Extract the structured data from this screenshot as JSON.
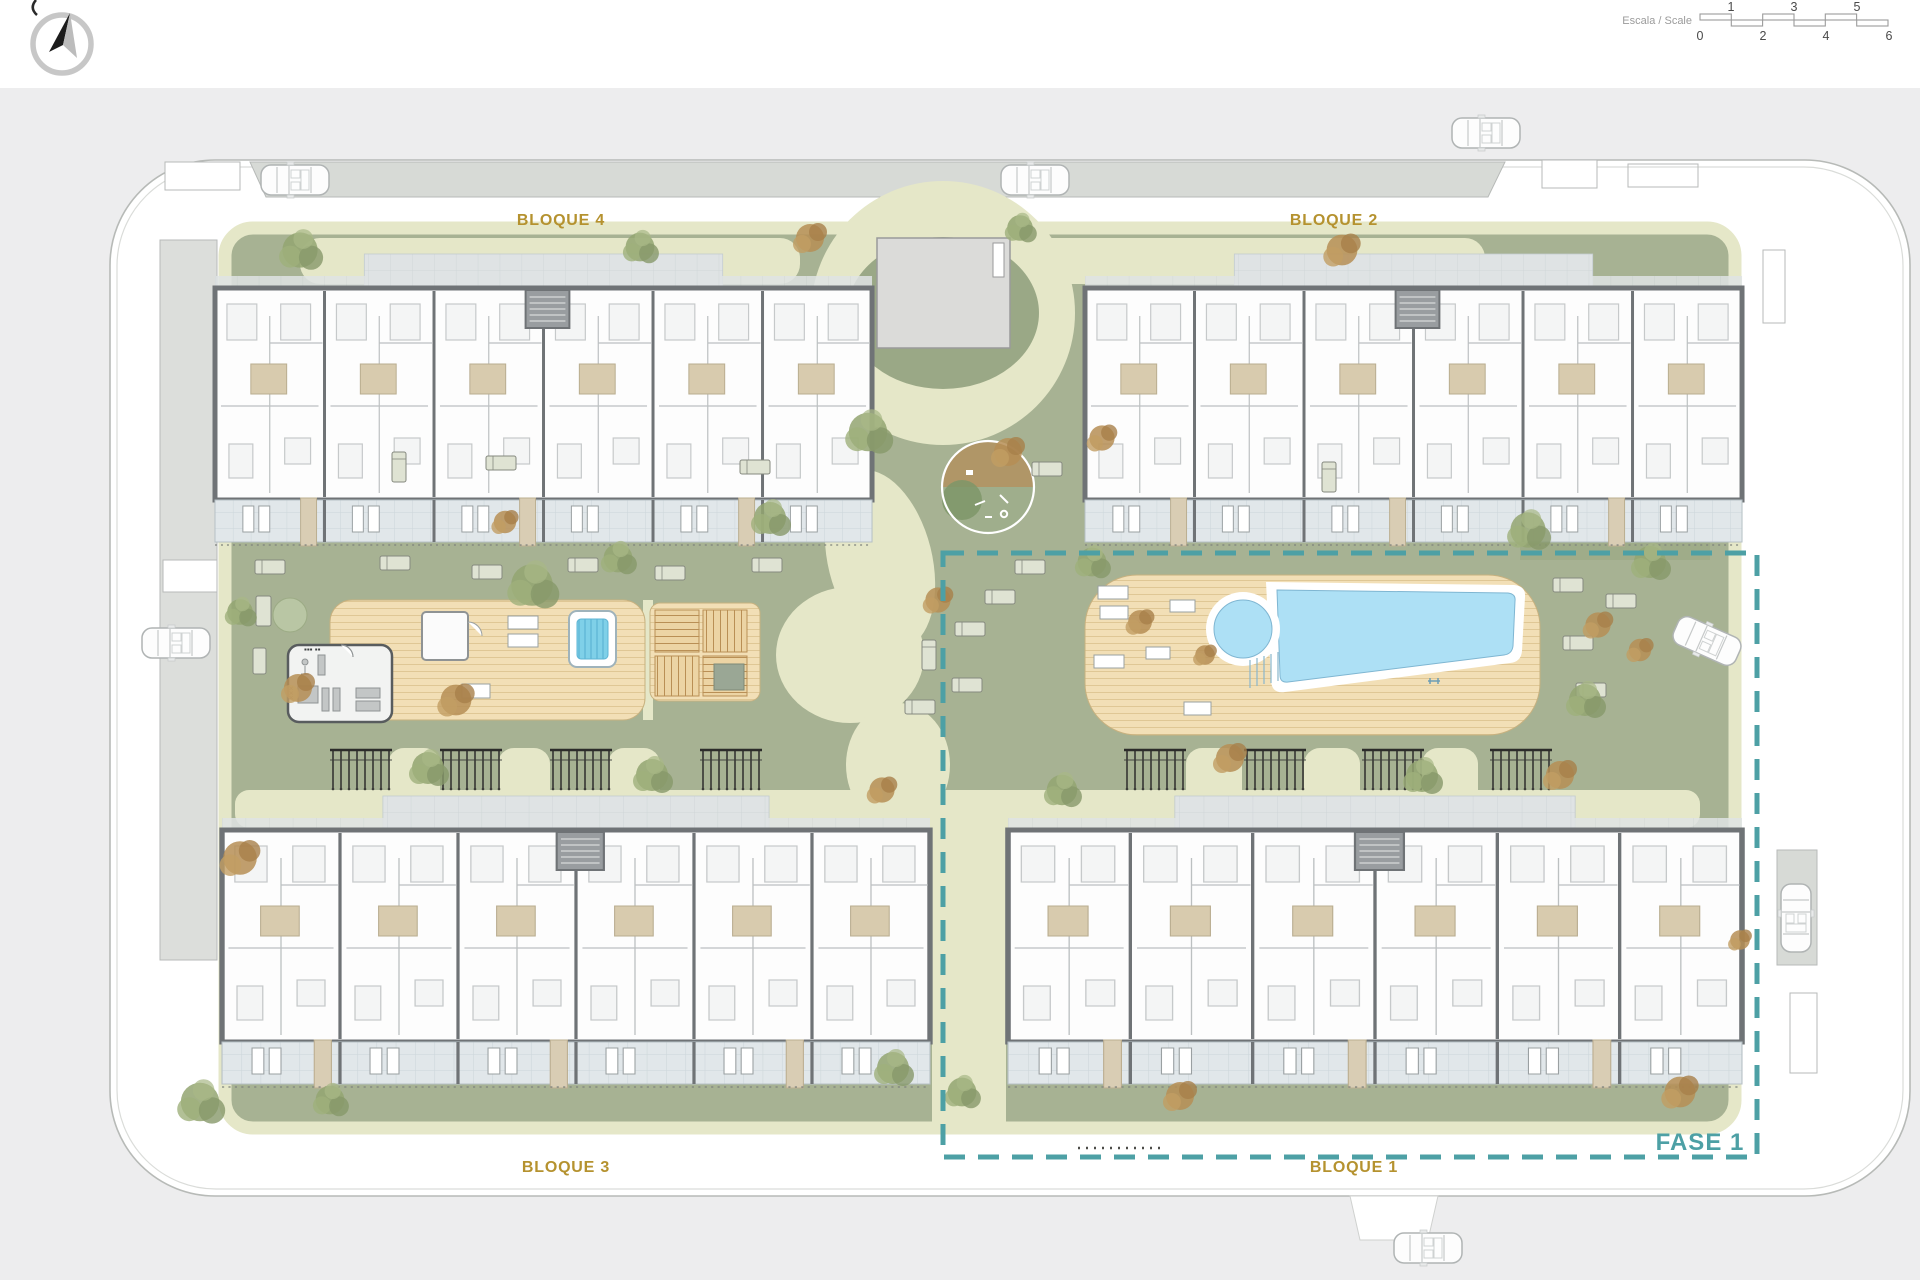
{
  "plan": {
    "phase_label": "FASE 1",
    "blocks": [
      {
        "id": "bloque-4",
        "label": "BLOQUE 4"
      },
      {
        "id": "bloque-2",
        "label": "BLOQUE 2"
      },
      {
        "id": "bloque-3",
        "label": "BLOQUE 3"
      },
      {
        "id": "bloque-1",
        "label": "BLOQUE 1"
      }
    ]
  },
  "scalebar": {
    "label": "Escala / Scale",
    "top": [
      "1",
      "3",
      "5"
    ],
    "bottom": [
      "0",
      "2",
      "4",
      "6"
    ]
  },
  "icons": {
    "compass": "north-compass"
  },
  "colors": {
    "block_label_gold": "#b5922f",
    "phase_teal": "#4da0a5",
    "lawn_green": "#a7b293",
    "path_cream": "#e5e7c8",
    "deck_tan": "#f2dfb6",
    "pool_blue": "#ade0f5",
    "terrace_gray_blue": "#e1e7ea",
    "wall_gray": "#6f7376",
    "road_white": "#ffffff",
    "parking_gray": "#d7dad6",
    "outer_gray": "#ededee"
  }
}
